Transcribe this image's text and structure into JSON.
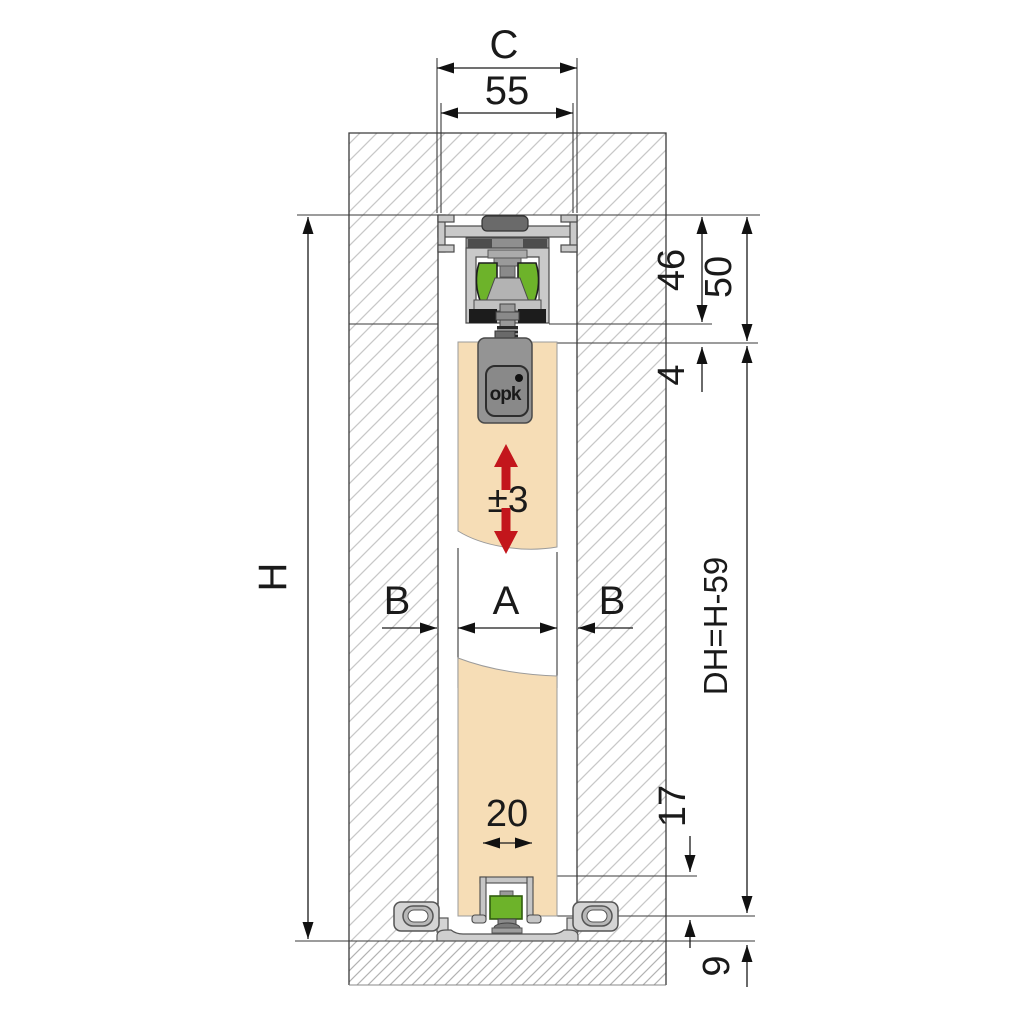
{
  "title": "sliding-door-hardware-section",
  "labels": {
    "c_overall_width": "C",
    "track_width_mm": "55",
    "carriage_height_mm": "46",
    "system_height_mm": "50",
    "top_gap_mm": "4",
    "opening_height": "H",
    "height_adjustment_mm": "±3",
    "door_width": "A",
    "overlap_left": "B",
    "overlap_right": "B",
    "door_height_formula": "DH=H-59",
    "groove_width_mm": "20",
    "groove_depth_mm": "17",
    "floor_clearance_mm": "9"
  },
  "logo": {
    "text": "opk"
  },
  "colors": {
    "roller_green": "#6db32a",
    "door_beige": "#f6ddb6",
    "adjust_red": "#c3161c",
    "metal_light": "#c9c9c9",
    "metal_mid": "#949494",
    "metal_dark": "#5a5a5a",
    "black_part": "#1c1c1c",
    "wall_hatch": "#c8c8c8",
    "floor_hatch": "#b2b2b2",
    "line": "#3a3a3a"
  }
}
